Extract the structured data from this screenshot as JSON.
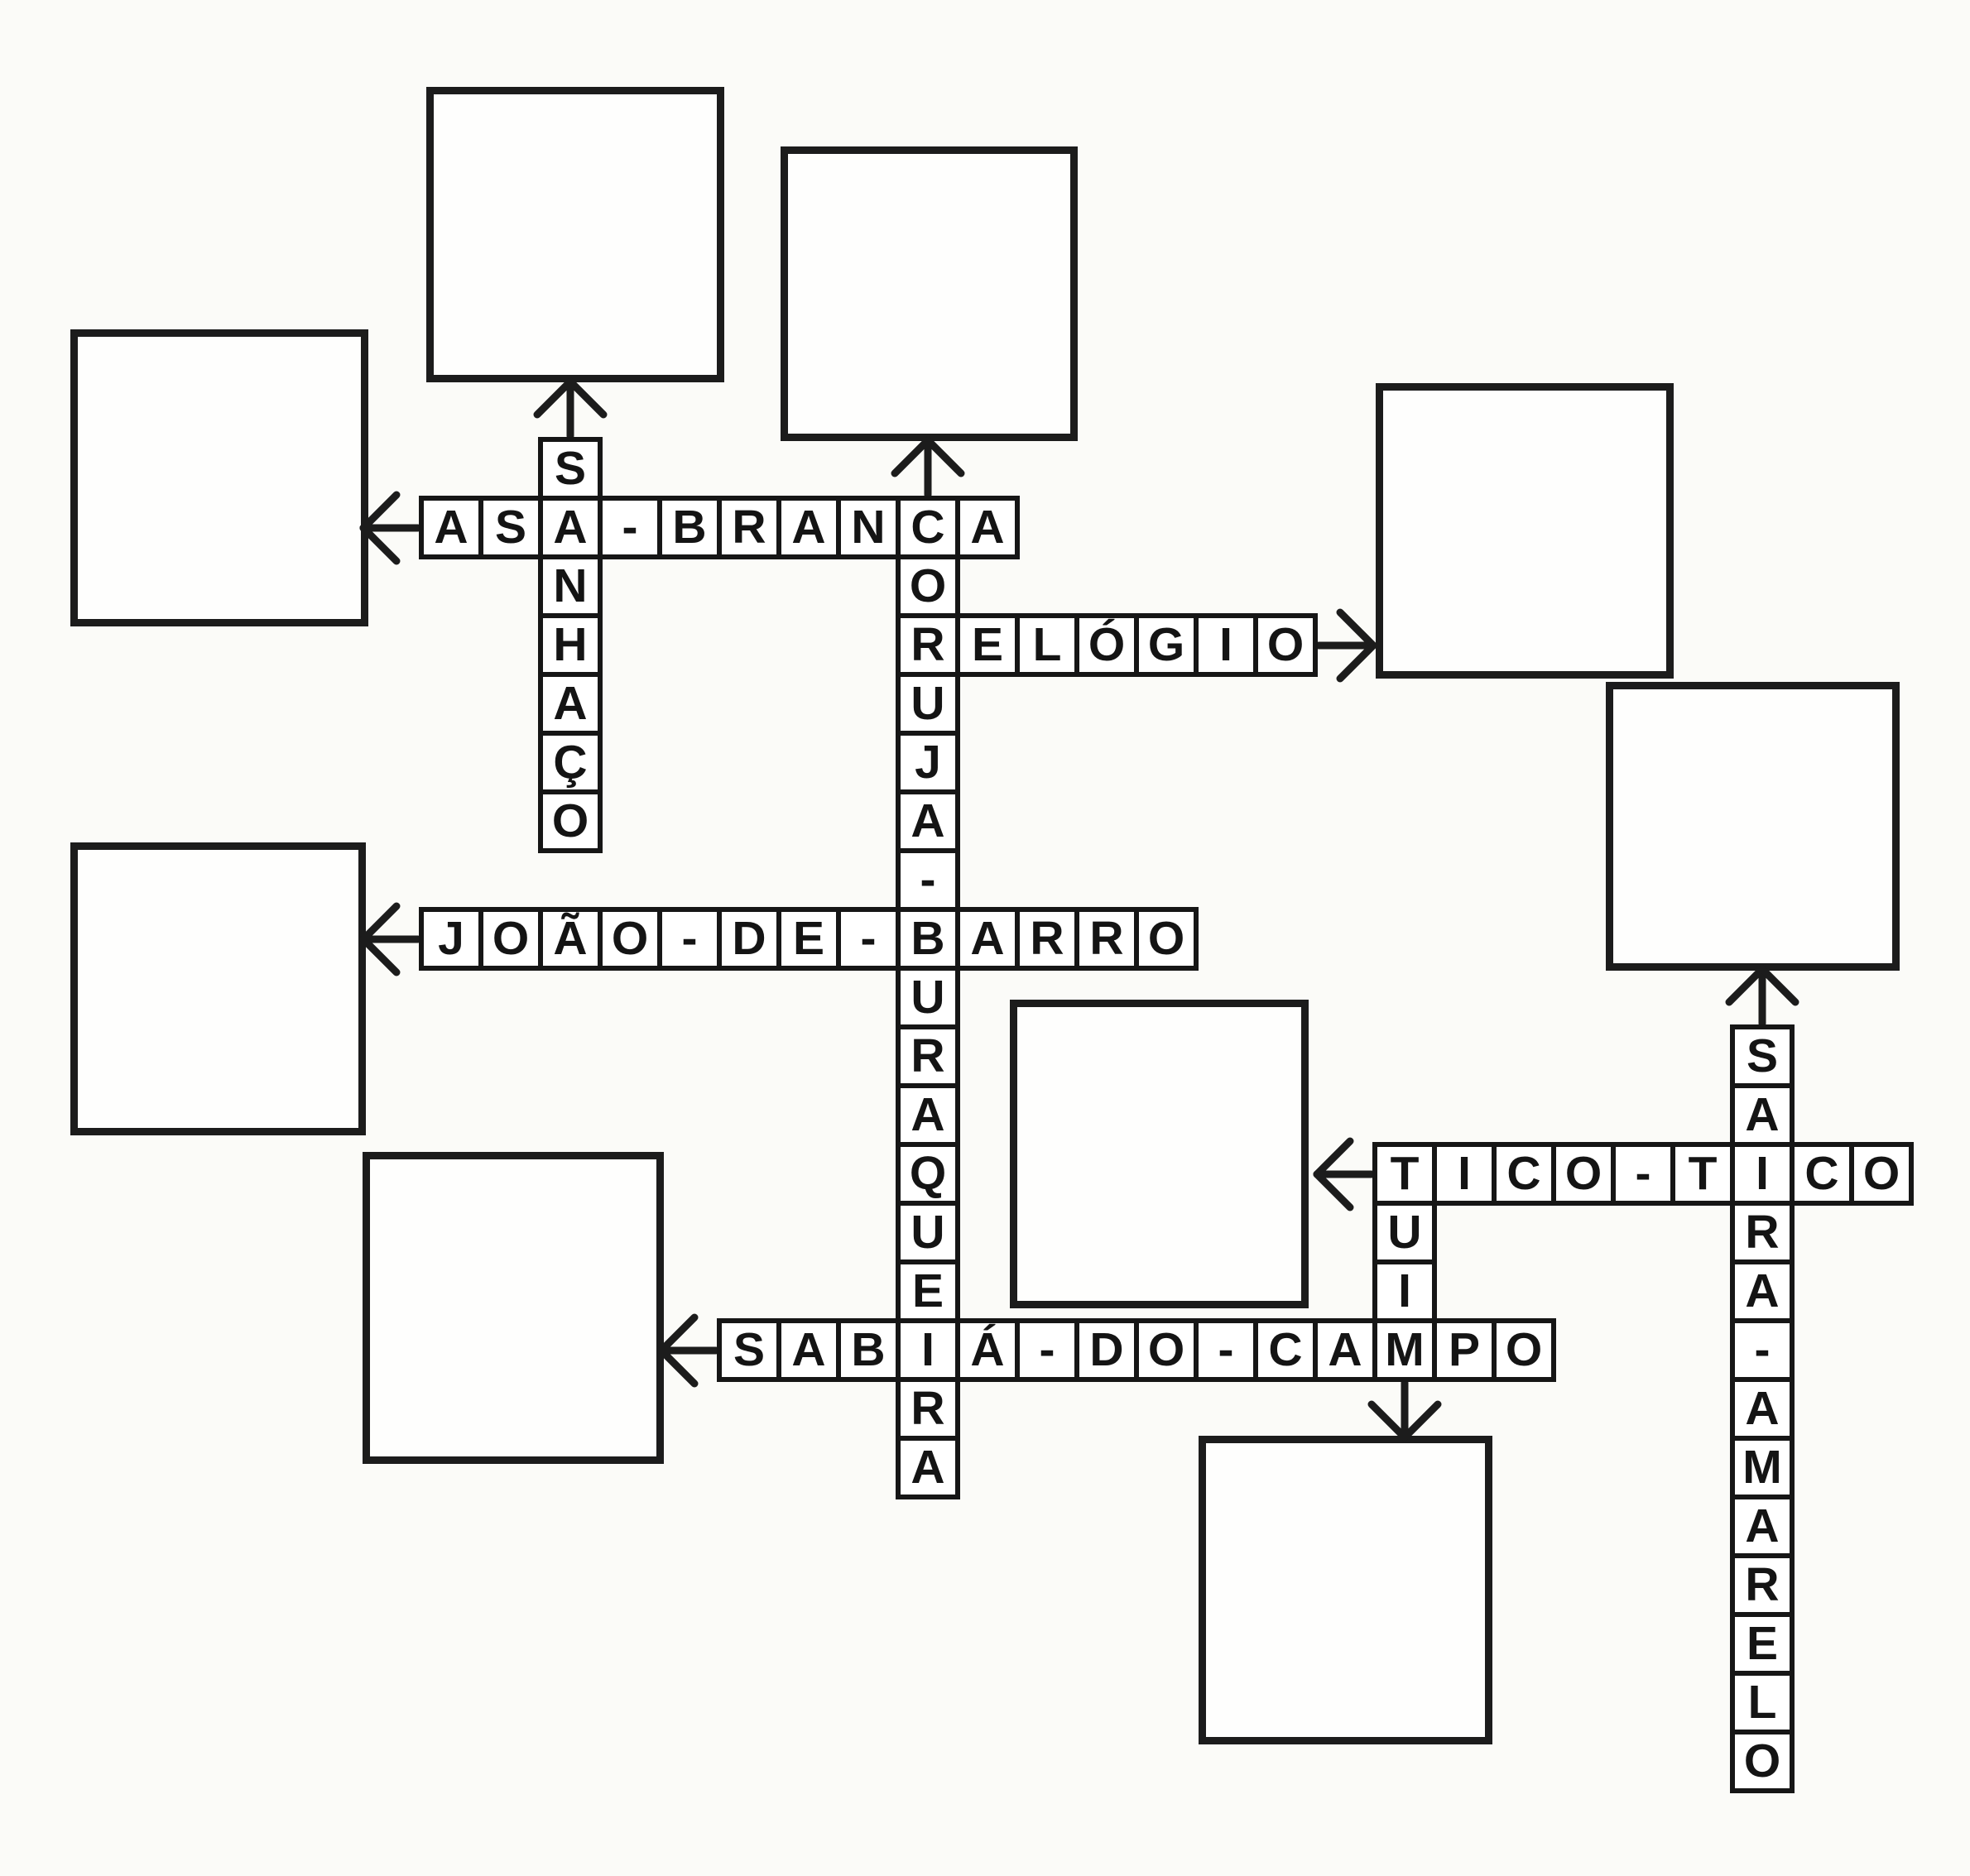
{
  "colors": {
    "ink": "#1c1c1c",
    "paper": "#fbfbf8",
    "cell_fill": "#ffffff"
  },
  "puzzle": {
    "type": "picture-crossword",
    "language": "pt-BR",
    "theme": "Brazilian birds",
    "words": [
      {
        "id": "asa-branca",
        "answer": "ASA-BRANCA",
        "direction": "across",
        "grid": {
          "col": 0,
          "row": 1
        },
        "cells": [
          "A",
          "S",
          "A",
          "-",
          "B",
          "R",
          "A",
          "N",
          "C",
          "A"
        ],
        "arrow": "left"
      },
      {
        "id": "sanhaco",
        "answer": "SANHAÇO",
        "direction": "down",
        "grid": {
          "col": 2,
          "row": 0
        },
        "cells": [
          "S",
          "A",
          "N",
          "H",
          "A",
          "Ç",
          "O"
        ],
        "arrow": "up"
      },
      {
        "id": "coruja-buraqueira",
        "answer": "CORUJA-BURAQUEIRA",
        "direction": "down",
        "grid": {
          "col": 8,
          "row": 1
        },
        "cells": [
          "C",
          "O",
          "R",
          "U",
          "J",
          "A",
          "-",
          "B",
          "U",
          "R",
          "A",
          "Q",
          "U",
          "E",
          "I",
          "R",
          "A"
        ],
        "arrow": "up"
      },
      {
        "id": "relogio",
        "answer": "RELÓGIO",
        "direction": "across",
        "grid": {
          "col": 8,
          "row": 3
        },
        "cells": [
          "R",
          "E",
          "L",
          "Ó",
          "G",
          "I",
          "O"
        ],
        "arrow": "right"
      },
      {
        "id": "joao-de-barro",
        "answer": "JOÃO-DE-BARRO",
        "direction": "across",
        "grid": {
          "col": 0,
          "row": 8
        },
        "cells": [
          "J",
          "O",
          "Ã",
          "O",
          "-",
          "D",
          "E",
          "-",
          "B",
          "A",
          "R",
          "R",
          "O"
        ],
        "arrow": "left"
      },
      {
        "id": "sabia-do-campo",
        "answer": "SABIÁ-DO-CAMPO",
        "direction": "across",
        "grid": {
          "col": 5,
          "row": 15
        },
        "cells": [
          "S",
          "A",
          "B",
          "I",
          "Á",
          "-",
          "D",
          "O",
          "-",
          "C",
          "A",
          "M",
          "P",
          "O"
        ],
        "arrow": "left"
      },
      {
        "id": "tico-tico",
        "answer": "TICO-TICO",
        "direction": "across",
        "grid": {
          "col": 16,
          "row": 12
        },
        "cells": [
          "T",
          "I",
          "C",
          "O",
          "-",
          "T",
          "I",
          "C",
          "O"
        ],
        "arrow": "left"
      },
      {
        "id": "tuim",
        "answer": "TUIM",
        "direction": "down",
        "grid": {
          "col": 16,
          "row": 12
        },
        "cells": [
          "T",
          "U",
          "I",
          "M"
        ],
        "arrow": "down"
      },
      {
        "id": "saira-amarelo",
        "answer": "SAIRA-AMARELO",
        "direction": "down",
        "grid": {
          "col": 22,
          "row": 10
        },
        "cells": [
          "S",
          "A",
          "I",
          "R",
          "A",
          "-",
          "A",
          "M",
          "A",
          "R",
          "E",
          "L",
          "O"
        ],
        "arrow": "up"
      }
    ],
    "boxes": [
      {
        "word": "asa-branca"
      },
      {
        "word": "sanhaco"
      },
      {
        "word": "coruja-buraqueira"
      },
      {
        "word": "relogio"
      },
      {
        "word": "saira-amarelo"
      },
      {
        "word": "joao-de-barro"
      },
      {
        "word": "sabia-do-campo"
      },
      {
        "word": "tico-tico"
      },
      {
        "word": "tuim"
      }
    ]
  }
}
